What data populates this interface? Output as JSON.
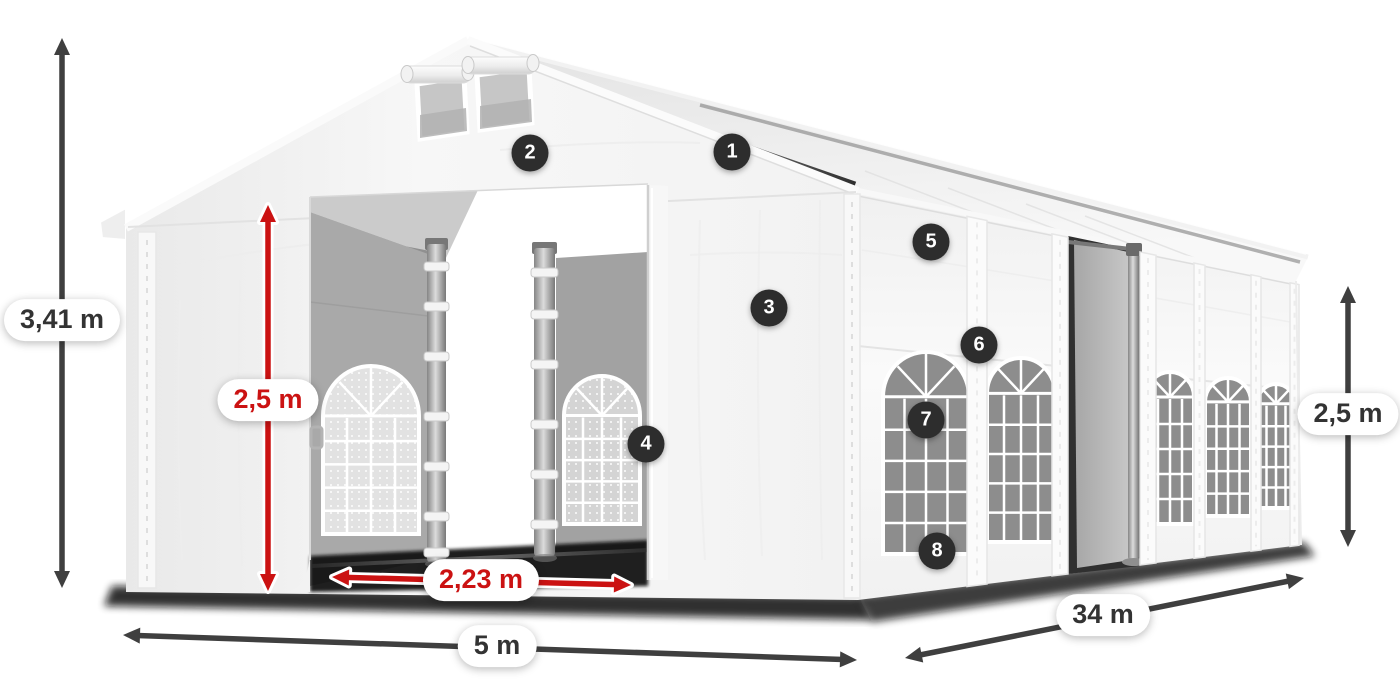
{
  "dimensions": {
    "total_height": {
      "label": "3,41 m"
    },
    "inner_height": {
      "label": "2,5 m"
    },
    "entrance_width": {
      "label": "2,23 m"
    },
    "width": {
      "label": "5 m"
    },
    "length": {
      "label": "34 m"
    },
    "side_height": {
      "label": "2,5 m"
    }
  },
  "markers": [
    {
      "label": "1"
    },
    {
      "label": "2"
    },
    {
      "label": "3"
    },
    {
      "label": "4"
    },
    {
      "label": "5"
    },
    {
      "label": "6"
    },
    {
      "label": "7"
    },
    {
      "label": "8"
    }
  ],
  "colors": {
    "accent_red": "#cb1212",
    "arrow_dark": "#3f3f3f",
    "badge_bg": "#2d2d2d",
    "label_text": "#333333"
  }
}
